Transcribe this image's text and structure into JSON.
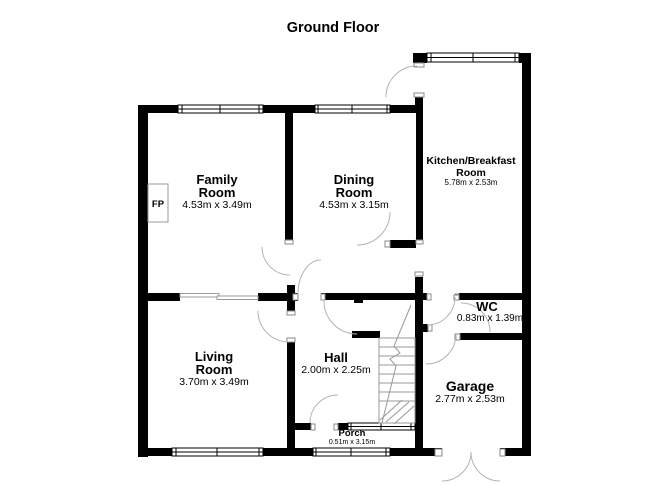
{
  "title": "Ground Floor",
  "fireplace": {
    "label": "FP"
  },
  "rooms": {
    "family": {
      "name1": "Family",
      "name2": "Room",
      "dims": "4.53m x 3.49m"
    },
    "dining": {
      "name1": "Dining",
      "name2": "Room",
      "dims": "4.53m x 3.15m"
    },
    "kitchen": {
      "name1": "Kitchen/Breakfast",
      "name2": "Room",
      "dims": "5.78m x 2.53m"
    },
    "living": {
      "name1": "Living",
      "name2": "Room",
      "dims": "3.70m x 3.49m"
    },
    "hall": {
      "name1": "Hall",
      "dims": "2.00m x 2.25m"
    },
    "wc": {
      "name1": "WC",
      "dims": "0.83m x 1.39m"
    },
    "garage": {
      "name1": "Garage",
      "dims": "2.77m x 2.53m"
    },
    "porch": {
      "name1": "Porch",
      "dims": "0.51m x 3.15m"
    }
  },
  "colors": {
    "wall": "#000000",
    "background": "#ffffff",
    "door_arc": "#b3b3b3",
    "stair_line": "#999999"
  }
}
